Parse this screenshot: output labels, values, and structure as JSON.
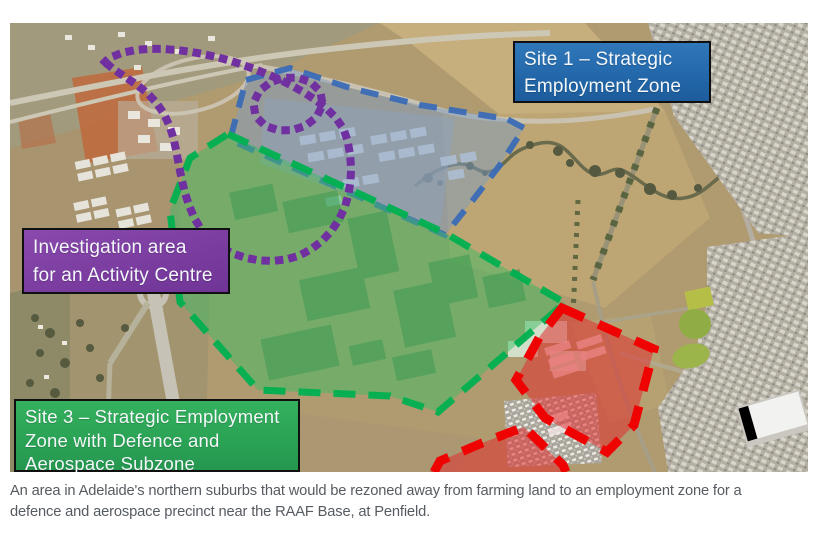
{
  "figure": {
    "caption": "An area in Adelaide's northern suburbs that would be rezoned away from farming land to an employment zone for a defence and aerospace precinct near the RAAF Base, at Penfield."
  },
  "map": {
    "labels": {
      "site1": "Site 1 – Strategic\nEmployment Zone",
      "investigation": "Investigation area\nfor an Activity Centre",
      "site3": "Site 3 – Strategic Employment\nZone with Defence and\nAerospace Subzone"
    },
    "zones": {
      "site1": {
        "fill": "#7D9BC2",
        "border": "#3B6CB6",
        "label_bg": "#2A6DB5"
      },
      "site3": {
        "fill": "#3DBB63",
        "border": "#00B050",
        "label_bg": "#2AA254"
      },
      "investigation": {
        "border": "#7030A0",
        "label_bg": "#7B3DA0",
        "outline_style": "dotted"
      },
      "red": {
        "fill": "#E03030",
        "border": "#EE0202"
      }
    }
  }
}
